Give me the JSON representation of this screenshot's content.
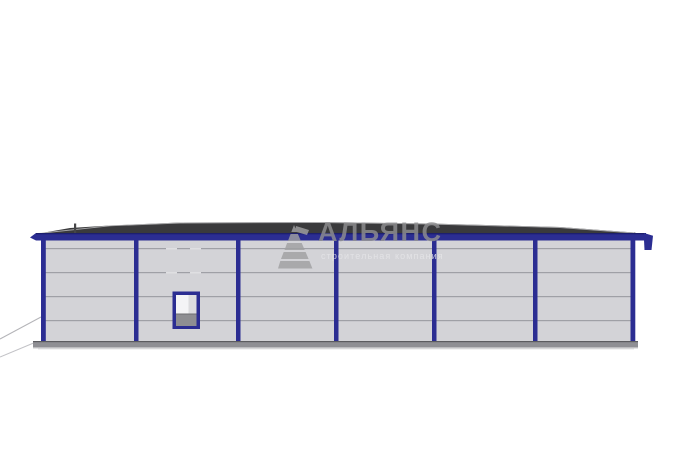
{
  "watermark": {
    "title": "АЛЬЯНС",
    "subtitle": "строительная компания",
    "logo": "striped-pyramid",
    "title_color": "#8f8f91",
    "subtitle_color": "#e6e6e9",
    "logo_color": "#a0a0a2"
  },
  "building": {
    "bay_count": 6,
    "panel_row_count": 5,
    "window_count": 1,
    "roof_vent_count": 1
  },
  "colors": {
    "navy": "#2b2d92",
    "navy_dark": "#1d1f6e",
    "roof": "#3a3a3c",
    "roof_edge_highlight": "#cccccd",
    "panel": "#d3d3d7",
    "panel_line": "#9fa0a6",
    "panel_dash": "#dfdfe2",
    "base": "#8f8f94",
    "base_edge": "#5c5c60",
    "base_bottom": "#bcbcbf",
    "window_inner_top": "#f4f4f6",
    "window_inner_shade": "#dcdcdf",
    "window_inner_bottom": "#8e8e92",
    "vent": "#464648",
    "ground_line": "#b4b4b8",
    "background": "#ffffff"
  }
}
